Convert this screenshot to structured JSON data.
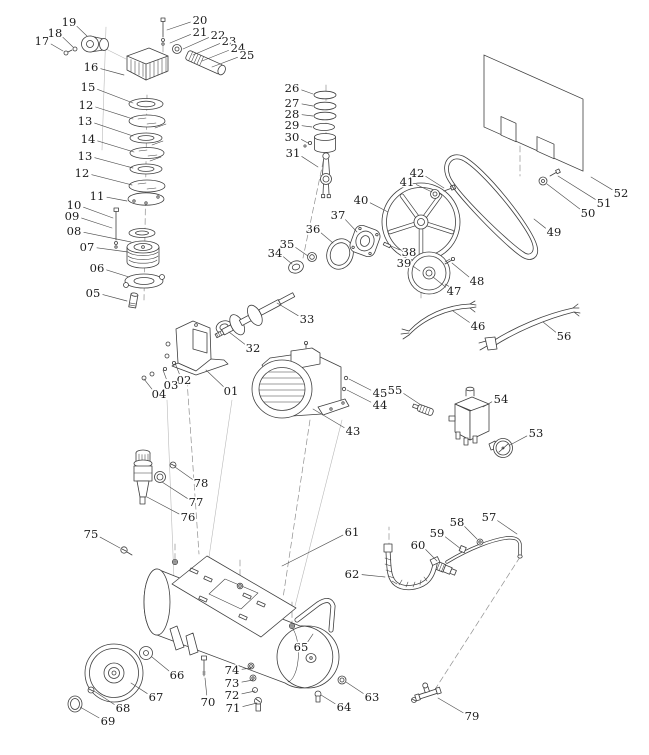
{
  "page": {
    "background": "#ffffff",
    "line_color": "#3f3f3f",
    "label_color": "#1c1c1c"
  },
  "diagram": {
    "type": "exploded-parts-diagram",
    "subject": "air compressor assembly",
    "labels": [
      {
        "num": "01",
        "x": 231,
        "y": 391,
        "tx": 206,
        "ty": 370
      },
      {
        "num": "02",
        "x": 184,
        "y": 380,
        "tx": 175,
        "ty": 363
      },
      {
        "num": "03",
        "x": 171,
        "y": 385,
        "tx": 163,
        "ty": 370
      },
      {
        "num": "04",
        "x": 159,
        "y": 394,
        "tx": 144,
        "ty": 379
      },
      {
        "num": "05",
        "x": 93,
        "y": 293,
        "tx": 127,
        "ty": 301
      },
      {
        "num": "06",
        "x": 97,
        "y": 268,
        "tx": 129,
        "ty": 277
      },
      {
        "num": "07",
        "x": 87,
        "y": 247,
        "tx": 128,
        "ty": 252
      },
      {
        "num": "08",
        "x": 74,
        "y": 231,
        "tx": 131,
        "ty": 242
      },
      {
        "num": "09",
        "x": 72,
        "y": 216,
        "tx": 112,
        "ty": 228
      },
      {
        "num": "10",
        "x": 74,
        "y": 205,
        "tx": 113,
        "ty": 218
      },
      {
        "num": "11",
        "x": 97,
        "y": 196,
        "tx": 127,
        "ty": 201
      },
      {
        "num": "12",
        "x": 86,
        "y": 105,
        "tx": 133,
        "ty": 119
      },
      {
        "num": "13",
        "x": 85,
        "y": 121,
        "tx": 133,
        "ty": 136
      },
      {
        "num": "14",
        "x": 88,
        "y": 139,
        "tx": 134,
        "ty": 152
      },
      {
        "num": "13",
        "x": 85,
        "y": 156,
        "tx": 133,
        "ty": 168
      },
      {
        "num": "12",
        "x": 82,
        "y": 173,
        "tx": 132,
        "ty": 185
      },
      {
        "num": "15",
        "x": 88,
        "y": 87,
        "tx": 133,
        "ty": 103
      },
      {
        "num": "16",
        "x": 91,
        "y": 67,
        "tx": 124,
        "ty": 75
      },
      {
        "num": "17",
        "x": 42,
        "y": 41,
        "tx": 63,
        "ty": 51
      },
      {
        "num": "18",
        "x": 55,
        "y": 33,
        "tx": 73,
        "ty": 47
      },
      {
        "num": "19",
        "x": 69,
        "y": 22,
        "tx": 87,
        "ty": 36
      },
      {
        "num": "20",
        "x": 200,
        "y": 20,
        "tx": 167,
        "ty": 30
      },
      {
        "num": "21",
        "x": 200,
        "y": 32,
        "tx": 170,
        "ty": 43
      },
      {
        "num": "22",
        "x": 218,
        "y": 35,
        "tx": 183,
        "ty": 49
      },
      {
        "num": "23",
        "x": 229,
        "y": 41,
        "tx": 193,
        "ty": 55
      },
      {
        "num": "24",
        "x": 238,
        "y": 48,
        "tx": 202,
        "ty": 61
      },
      {
        "num": "25",
        "x": 247,
        "y": 55,
        "tx": 212,
        "ty": 67
      },
      {
        "num": "26",
        "x": 292,
        "y": 88,
        "tx": 313,
        "ty": 94
      },
      {
        "num": "27",
        "x": 292,
        "y": 103,
        "tx": 313,
        "ty": 106
      },
      {
        "num": "28",
        "x": 292,
        "y": 114,
        "tx": 313,
        "ty": 116
      },
      {
        "num": "29",
        "x": 292,
        "y": 125,
        "tx": 312,
        "ty": 127
      },
      {
        "num": "30",
        "x": 292,
        "y": 137,
        "tx": 308,
        "ty": 143
      },
      {
        "num": "31",
        "x": 293,
        "y": 153,
        "tx": 318,
        "ty": 167
      },
      {
        "num": "32",
        "x": 253,
        "y": 348,
        "tx": 229,
        "ty": 332
      },
      {
        "num": "33",
        "x": 307,
        "y": 319,
        "tx": 277,
        "ty": 303
      },
      {
        "num": "34",
        "x": 275,
        "y": 253,
        "tx": 292,
        "ty": 264
      },
      {
        "num": "35",
        "x": 287,
        "y": 244,
        "tx": 308,
        "ty": 256
      },
      {
        "num": "36",
        "x": 313,
        "y": 229,
        "tx": 333,
        "ty": 243
      },
      {
        "num": "37",
        "x": 338,
        "y": 215,
        "tx": 357,
        "ty": 232
      },
      {
        "num": "38",
        "x": 409,
        "y": 252,
        "tx": 391,
        "ty": 246
      },
      {
        "num": "39",
        "x": 404,
        "y": 263,
        "tx": 420,
        "ty": 271
      },
      {
        "num": "40",
        "x": 361,
        "y": 200,
        "tx": 388,
        "ty": 212
      },
      {
        "num": "41",
        "x": 407,
        "y": 182,
        "tx": 432,
        "ty": 192
      },
      {
        "num": "42",
        "x": 417,
        "y": 173,
        "tx": 444,
        "ty": 188
      },
      {
        "num": "43",
        "x": 353,
        "y": 431,
        "tx": 313,
        "ty": 409
      },
      {
        "num": "44",
        "x": 380,
        "y": 405,
        "tx": 347,
        "ty": 390
      },
      {
        "num": "45",
        "x": 380,
        "y": 393,
        "tx": 349,
        "ty": 379
      },
      {
        "num": "46",
        "x": 478,
        "y": 326,
        "tx": 453,
        "ty": 311
      },
      {
        "num": "47",
        "x": 454,
        "y": 291,
        "tx": 433,
        "ty": 277
      },
      {
        "num": "48",
        "x": 477,
        "y": 281,
        "tx": 452,
        "ty": 263
      },
      {
        "num": "49",
        "x": 554,
        "y": 232,
        "tx": 534,
        "ty": 219
      },
      {
        "num": "50",
        "x": 588,
        "y": 213,
        "tx": 547,
        "ty": 184
      },
      {
        "num": "51",
        "x": 604,
        "y": 203,
        "tx": 558,
        "ty": 176
      },
      {
        "num": "52",
        "x": 621,
        "y": 193,
        "tx": 591,
        "ty": 177
      },
      {
        "num": "53",
        "x": 536,
        "y": 433,
        "tx": 510,
        "ty": 445
      },
      {
        "num": "54",
        "x": 501,
        "y": 399,
        "tx": 483,
        "ty": 407
      },
      {
        "num": "55",
        "x": 395,
        "y": 390,
        "tx": 421,
        "ty": 405
      },
      {
        "num": "56",
        "x": 564,
        "y": 336,
        "tx": 543,
        "ty": 322
      },
      {
        "num": "57",
        "x": 489,
        "y": 517,
        "tx": 517,
        "ty": 534
      },
      {
        "num": "58",
        "x": 457,
        "y": 522,
        "tx": 477,
        "ty": 539
      },
      {
        "num": "59",
        "x": 437,
        "y": 533,
        "tx": 461,
        "ty": 549
      },
      {
        "num": "60",
        "x": 418,
        "y": 545,
        "tx": 437,
        "ty": 561
      },
      {
        "num": "61",
        "x": 352,
        "y": 532,
        "tx": 282,
        "ty": 566
      },
      {
        "num": "62",
        "x": 352,
        "y": 574,
        "tx": 385,
        "ty": 577
      },
      {
        "num": "63",
        "x": 372,
        "y": 697,
        "tx": 346,
        "ty": 682
      },
      {
        "num": "64",
        "x": 344,
        "y": 707,
        "tx": 321,
        "ty": 695
      },
      {
        "num": "65",
        "x": 301,
        "y": 647,
        "tx": 313,
        "ty": 634
      },
      {
        "num": "66",
        "x": 177,
        "y": 675,
        "tx": 152,
        "ty": 657
      },
      {
        "num": "67",
        "x": 156,
        "y": 697,
        "tx": 131,
        "ty": 683
      },
      {
        "num": "68",
        "x": 123,
        "y": 708,
        "tx": 94,
        "ty": 691
      },
      {
        "num": "69",
        "x": 108,
        "y": 721,
        "tx": 80,
        "ty": 707
      },
      {
        "num": "70",
        "x": 208,
        "y": 702,
        "tx": 205,
        "ty": 678
      },
      {
        "num": "71",
        "x": 233,
        "y": 708,
        "tx": 257,
        "ty": 703
      },
      {
        "num": "72",
        "x": 232,
        "y": 695,
        "tx": 255,
        "ty": 691
      },
      {
        "num": "73",
        "x": 232,
        "y": 683,
        "tx": 253,
        "ty": 680
      },
      {
        "num": "74",
        "x": 232,
        "y": 670,
        "tx": 251,
        "ty": 668
      },
      {
        "num": "75",
        "x": 91,
        "y": 534,
        "tx": 120,
        "ty": 548
      },
      {
        "num": "76",
        "x": 188,
        "y": 517,
        "tx": 147,
        "ty": 497
      },
      {
        "num": "77",
        "x": 196,
        "y": 502,
        "tx": 162,
        "ty": 482
      },
      {
        "num": "78",
        "x": 201,
        "y": 483,
        "tx": 175,
        "ty": 467
      },
      {
        "num": "79",
        "x": 472,
        "y": 716,
        "tx": 438,
        "ty": 698
      }
    ]
  }
}
